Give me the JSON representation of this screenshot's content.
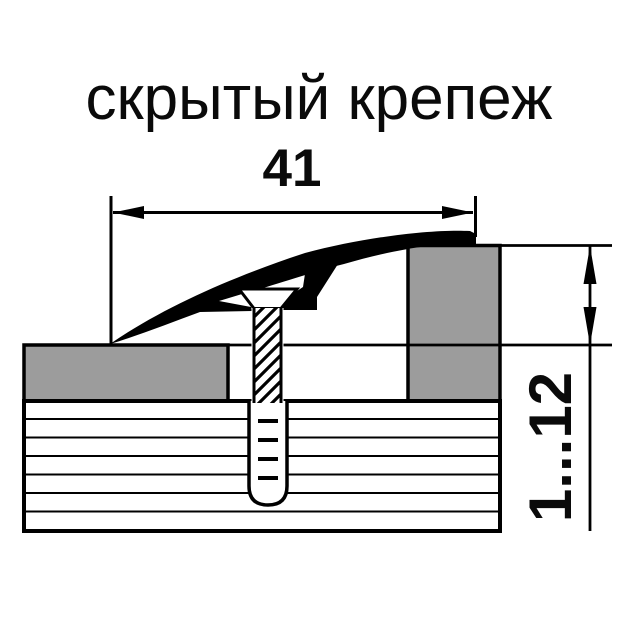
{
  "title": "скрытый крепеж",
  "dimensions": {
    "width_label": "41",
    "height_label": "1...12"
  },
  "colors": {
    "background": "#ffffff",
    "line_black": "#000000",
    "flooring_gray": "#9c9c9c",
    "text_black": "#0a0a0a"
  }
}
